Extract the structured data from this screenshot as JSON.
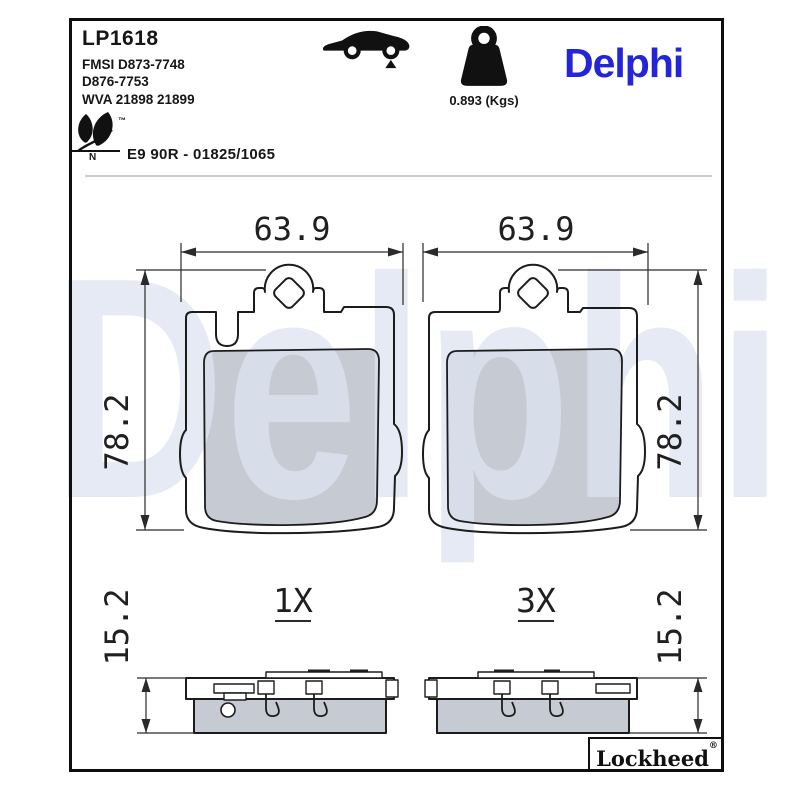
{
  "header": {
    "part_number": "LP1618",
    "fmsi_line1": "FMSI D873-7748",
    "fmsi_line2": "D876-7753",
    "wva": "WVA 21898 21899",
    "weight": "0.893 (Kgs)",
    "brand": "Delphi",
    "leaf_tm": "™",
    "leaf_n": "N",
    "approval": "E9 90R - 01825/1065"
  },
  "drawing": {
    "watermark": "Delphi",
    "front_left": {
      "width": "63.9",
      "height": "78.2"
    },
    "front_right": {
      "width": "63.9",
      "height": "78.2"
    },
    "side_left": {
      "thickness": "15.2",
      "count": "1X"
    },
    "side_right": {
      "thickness": "15.2",
      "count": "3X"
    }
  },
  "footer": {
    "brand": "Lockheed",
    "registered": "®"
  },
  "colors": {
    "brand_blue": "#2424D8",
    "watermark_blue": "#DCE3F0",
    "friction_gray": "#C6CBD3",
    "line_dark": "#1C1C1C",
    "divider_gray": "#CBCBCB"
  }
}
